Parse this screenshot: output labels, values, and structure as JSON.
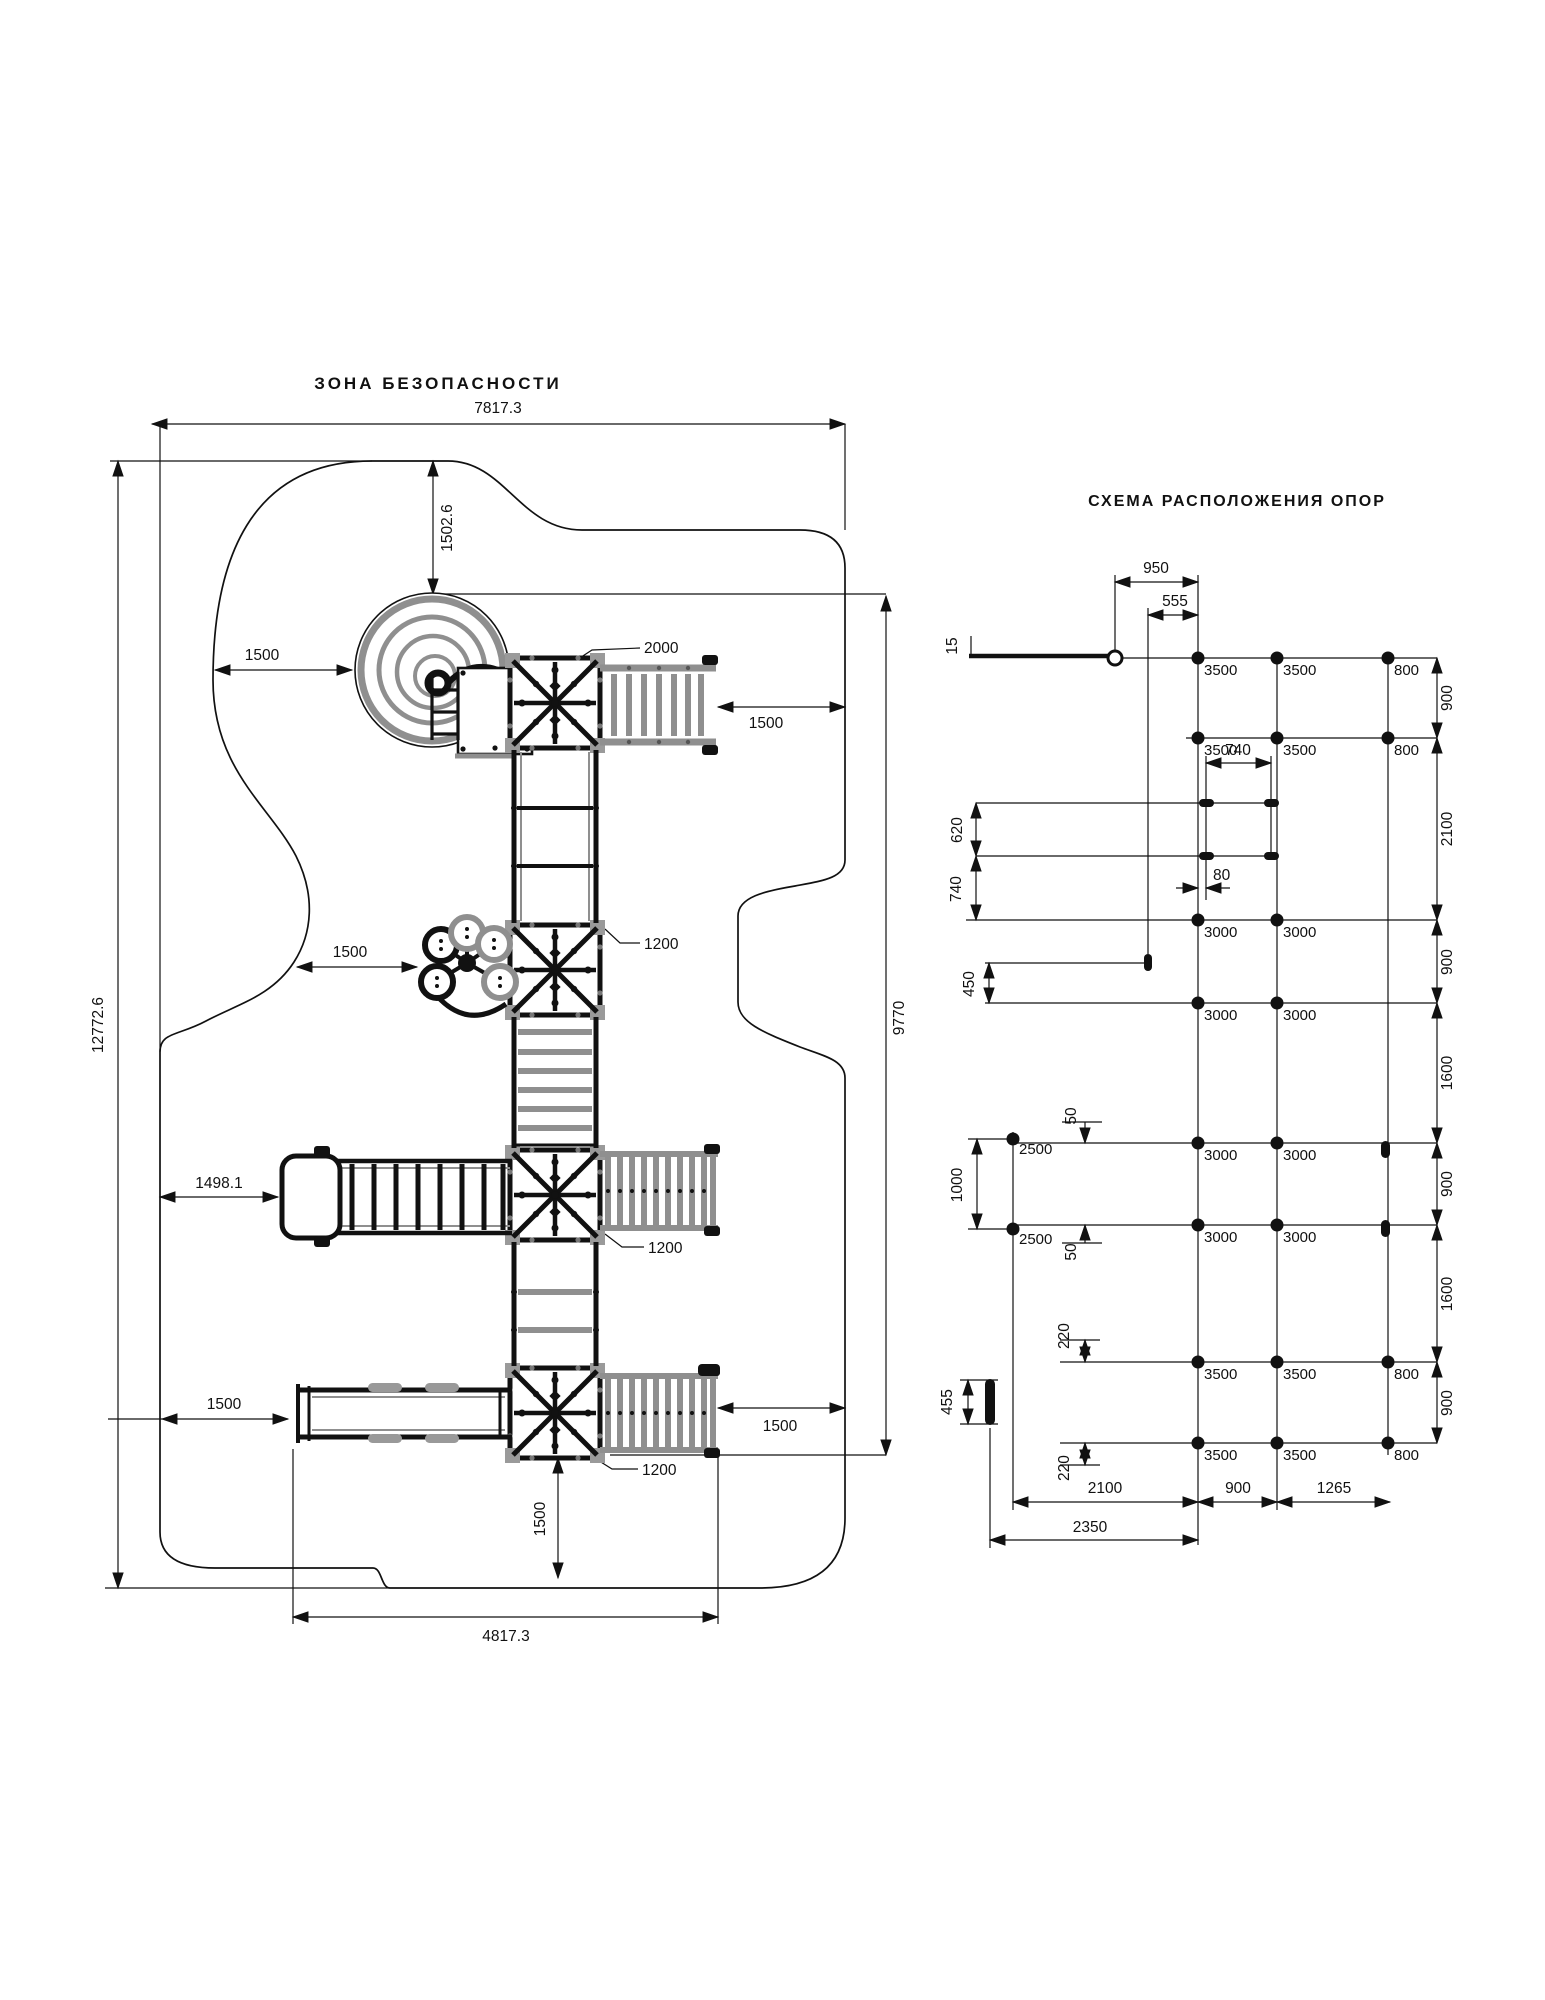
{
  "left_diagram": {
    "title": "ЗОНА БЕЗОПАСНОСТИ",
    "dimensions": {
      "safety_zone_width": "7817.3",
      "safety_zone_height": "12772.6",
      "equipment_height": "9770",
      "equipment_width_bottom": "4817.3",
      "top_clearance": "1502.6",
      "spiral_clearance_left": "1500",
      "tower_top_size": "2000",
      "clearance_top_right": "1500",
      "climber_clearance_left": "1500",
      "tower2_size": "1200",
      "ramp_clearance_left": "1498.1",
      "tower3_size": "1200",
      "slide_clearance_left": "1500",
      "clearance_bottom_right": "1500",
      "tower4_size": "1200",
      "clearance_bottom": "1500"
    }
  },
  "right_diagram": {
    "title": "СХЕМА РАСПОЛОЖЕНИЯ ОПОР",
    "top_dimensions": {
      "d950": "950",
      "d555": "555",
      "d15": "15"
    },
    "left_dimensions": {
      "d620": "620",
      "d740": "740",
      "d450": "450",
      "d1000": "1000",
      "d50_upper": "50",
      "d50_lower": "50",
      "d220_upper": "220",
      "d220_lower": "220",
      "d455": "455"
    },
    "inner_dimensions": {
      "d740": "740",
      "d80": "80"
    },
    "right_dimensions": [
      "900",
      "2100",
      "900",
      "1600",
      "900",
      "1600",
      "900"
    ],
    "bottom_dimensions": {
      "d2100": "2100",
      "d900": "900",
      "d1265": "1265",
      "d2350": "2350"
    },
    "support_labels": {
      "row1": [
        "3500",
        "3500",
        "800"
      ],
      "row2": [
        "3500",
        "3500",
        "800"
      ],
      "row3": [
        "3000",
        "3000"
      ],
      "row4": [
        "3000",
        "3000"
      ],
      "row5": [
        "3000",
        "3000"
      ],
      "row6": [
        "3000",
        "3000"
      ],
      "row7": [
        "3500",
        "3500",
        "800"
      ],
      "row8": [
        "3500",
        "3500",
        "800"
      ],
      "left_col": [
        "2500",
        "2500"
      ]
    }
  }
}
